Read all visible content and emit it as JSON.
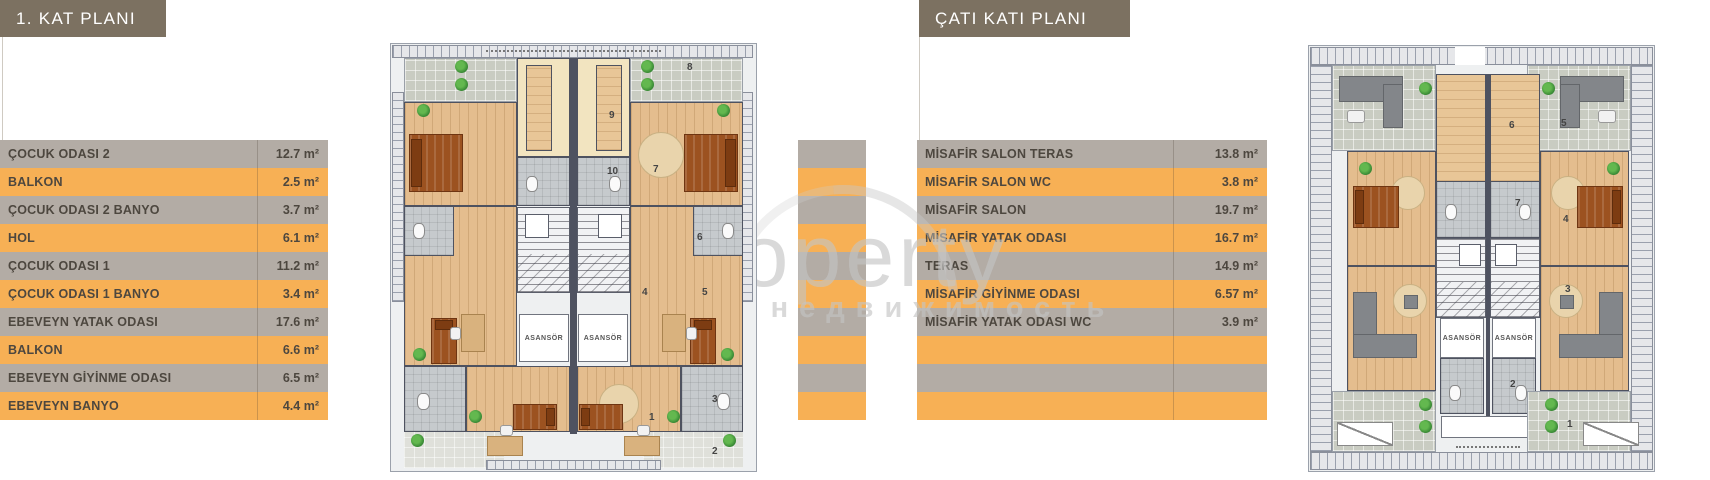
{
  "left_card": {
    "title": "1. KAT PLANI",
    "rows": [
      {
        "label": "ÇOCUK ODASI 2",
        "value": "12.7 m²"
      },
      {
        "label": "BALKON",
        "value": "2.5 m²"
      },
      {
        "label": "ÇOCUK ODASI 2 BANYO",
        "value": "3.7 m²"
      },
      {
        "label": "HOL",
        "value": "6.1 m²"
      },
      {
        "label": "ÇOCUK ODASI 1",
        "value": "11.2 m²"
      },
      {
        "label": "ÇOCUK ODASI 1 BANYO",
        "value": "3.4 m²"
      },
      {
        "label": "EBEVEYN YATAK ODASI",
        "value": "17.6 m²"
      },
      {
        "label": "BALKON",
        "value": "6.6 m²"
      },
      {
        "label": "EBEVEYN GİYİNME ODASI",
        "value": "6.5 m²"
      },
      {
        "label": "EBEVEYN BANYO",
        "value": "4.4 m²"
      }
    ],
    "plan": {
      "elevator_label": "ASANSÖR",
      "room_numbers": [
        "8",
        "9",
        "10",
        "7",
        "6",
        "4",
        "5",
        "3",
        "1",
        "2"
      ]
    }
  },
  "right_card": {
    "title": "ÇATI KATI PLANI",
    "rows": [
      {
        "label": "MİSAFİR SALON TERAS",
        "value": "13.8 m²"
      },
      {
        "label": "MİSAFİR SALON WC",
        "value": "3.8 m²"
      },
      {
        "label": "MİSAFİR SALON",
        "value": "19.7 m²"
      },
      {
        "label": "MİSAFİR YATAK ODASI",
        "value": "16.7 m²"
      },
      {
        "label": "TERAS",
        "value": "14.9 m²"
      },
      {
        "label": "MİSAFİR GİYİNME ODASI",
        "value": "6.57 m²"
      },
      {
        "label": "MİSAFİR YATAK ODASI WC",
        "value": "3.9 m²"
      },
      {
        "label": "",
        "value": ""
      },
      {
        "label": "",
        "value": ""
      },
      {
        "label": "",
        "value": ""
      }
    ],
    "plan": {
      "elevator_label": "ASANSÖR",
      "room_numbers": [
        "5",
        "6",
        "7",
        "4",
        "3",
        "2",
        "1"
      ]
    }
  },
  "watermark": {
    "brand": "tProperty",
    "tagline": "ная недвижимость"
  },
  "colors": {
    "row_gray": "#b3aca5",
    "row_orange": "#f7b055",
    "title_bg": "#7c7161",
    "text": "#4d473f"
  }
}
